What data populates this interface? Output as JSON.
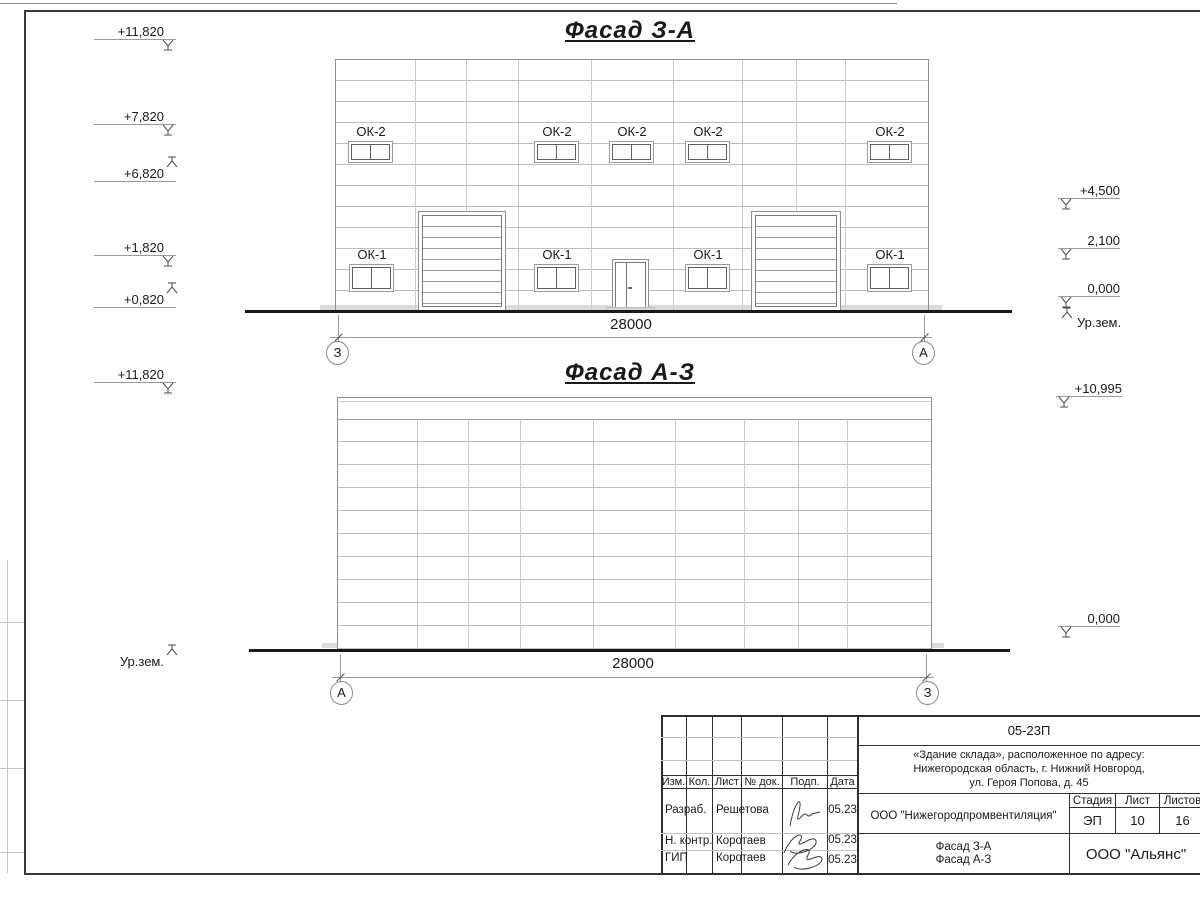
{
  "colors": {
    "ink": "#1a1a1a",
    "frame": "#3a3a3a",
    "panel_line": "#bdbdbd",
    "ground": "#181818"
  },
  "facade1": {
    "title": "Фасад З-А",
    "dim": "28000",
    "axis_left": "З",
    "axis_right": "А",
    "ok2_label": "ОК-2",
    "ok1_label": "ОК-1",
    "elev_left": [
      {
        "text": "+11,820",
        "dir": "down"
      },
      {
        "text": "+7,820",
        "dir": "down"
      },
      {
        "text": "+6,820",
        "dir": "up"
      },
      {
        "text": "+1,820",
        "dir": "down"
      },
      {
        "text": "+0,820",
        "dir": "up"
      }
    ],
    "elev_right": [
      {
        "text": "+4,500",
        "dir": "down"
      },
      {
        "text": "2,100",
        "dir": "down"
      },
      {
        "text": "0,000",
        "dir": "down"
      },
      {
        "text": "Ур.зем.",
        "dir": "up"
      }
    ]
  },
  "facade2": {
    "title": "Фасад А-З",
    "dim": "28000",
    "axis_left": "А",
    "axis_right": "З",
    "elev_left": [
      {
        "text": "+11,820",
        "dir": "down"
      },
      {
        "text": "Ур.зем.",
        "dir": "up"
      }
    ],
    "elev_right": [
      {
        "text": "+10,995",
        "dir": "down"
      },
      {
        "text": "0,000",
        "dir": "down"
      }
    ]
  },
  "title_block": {
    "project_code": "05-23П",
    "address_line1": "«Здание склада», расположенное по адресу:",
    "address_line2": "Нижегородская область, г. Нижний Новгород,",
    "address_line3": "ул. Героя Попова, д. 45",
    "columns": {
      "izm": "Изм.",
      "kol": "Кол.",
      "list": "Лист",
      "ndok": "№ док.",
      "podp": "Подп.",
      "data": "Дата"
    },
    "rows": [
      {
        "role": "Разраб.",
        "name": "Решетова",
        "date": "05.23"
      },
      {
        "role": "Н. контр.",
        "name": "Коротаев",
        "date": "05.23"
      },
      {
        "role": "ГИП",
        "name": "Коротаев",
        "date": "05.23"
      }
    ],
    "organization": "ООО \"Нижегородпромвентиляция\"",
    "stage_label": "Стадия",
    "sheet_label": "Лист",
    "sheets_label": "Листов",
    "stage": "ЭП",
    "sheet_no": "10",
    "sheets_total": "16",
    "drawing_title_line1": "Фасад З-А",
    "drawing_title_line2": "Фасад А-З",
    "company": "ООО \"Альянс\""
  }
}
